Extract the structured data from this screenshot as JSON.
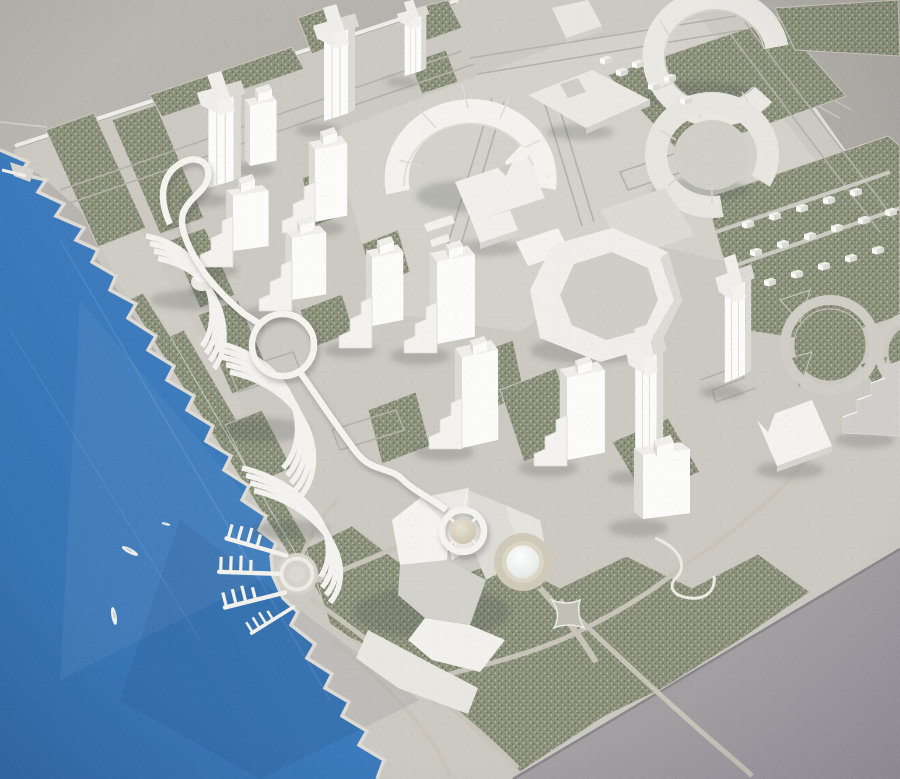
{
  "scene": {
    "alt": "Photograph of a white architectural scale model of a waterfront city master plan on a grey table, with blue water at lower left, speckled green park parcels, white towers and an elevated looping white roadway",
    "objects": {
      "water_area": "harbor",
      "boats": 3,
      "finger_piers": 4,
      "pier_plaza": 1,
      "office_towers": 6,
      "cross_plan_towers": 5,
      "stepped_ziggurat_wings": 6,
      "ring_buildings": 2,
      "curved_wall_building": 1,
      "octagon_courtyard_building": 1,
      "terraced_waterfront_buildings": 3,
      "sculptural_hall": 1,
      "dome_pavilion": 1,
      "sphere_monument": 1,
      "roundabouts": 2,
      "small_house_blocks": 22,
      "elevated_road_loops": 2
    }
  },
  "colors": {
    "table_light": "#bcb9b3",
    "table_dark": "#9a97a0",
    "plate": "#ccc9c2",
    "plaza": "#d4d1ca",
    "road_line": "#b4b1aa",
    "park_path": "#c8c4b9",
    "green_base": "#8d927c",
    "green_dark": "#676d56",
    "green_light": "#c6cbbc",
    "curb": "#cbc8c0",
    "water_top": "#4384c7",
    "water_deep": "#3470af",
    "bldg_top": "#efeeea",
    "bldg_light": "#f3f2ee",
    "bldg_bright": "#fbfbf9",
    "bldg_shade": "#dbdad5",
    "bldg_dark": "#cfcecb",
    "edge": "#eeede9",
    "white_road": "#f5f3ed",
    "dome_base": "#cfc9b8",
    "sphere": "#d8d1bd",
    "shadow": "rgba(70,72,78,0.22)",
    "shore_edge": "#dddbd4"
  }
}
